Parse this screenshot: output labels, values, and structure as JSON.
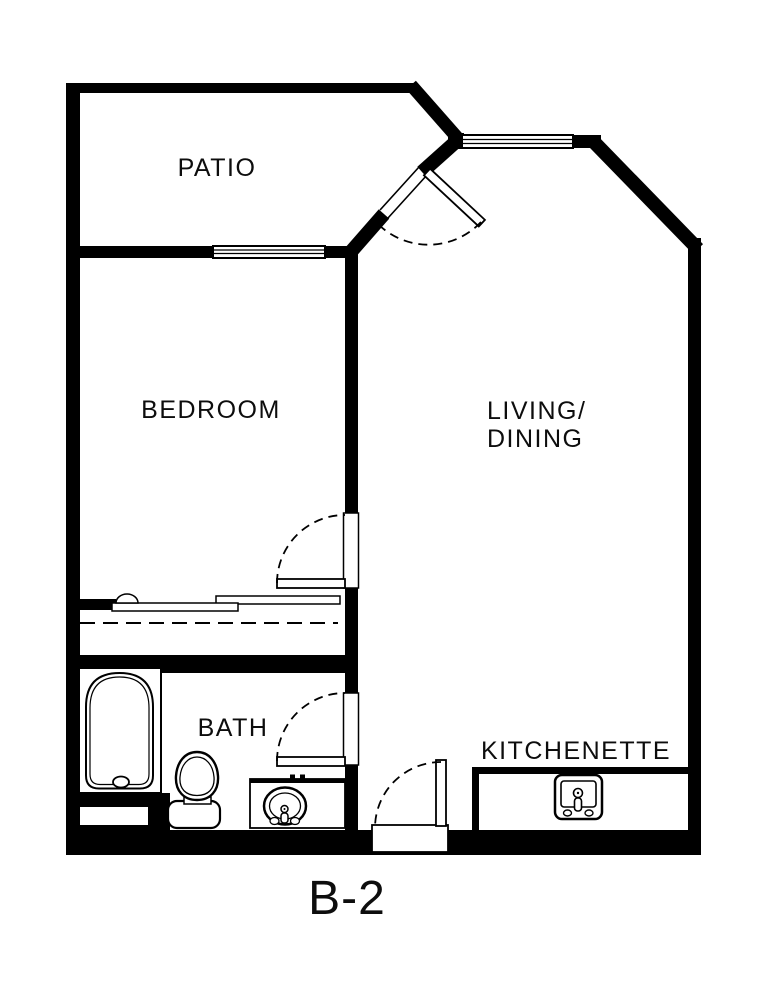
{
  "plan": {
    "title": "B-2"
  },
  "colors": {
    "wall": "#000000",
    "background": "#ffffff",
    "label_text": "#0d0d0d"
  },
  "rooms": {
    "patio": {
      "label": "PATIO"
    },
    "bedroom": {
      "label": "BEDROOM"
    },
    "living_dining": {
      "label_line1": "LIVING/",
      "label_line2": "DINING"
    },
    "bath": {
      "label": "BATH"
    },
    "kitchenette": {
      "label": "KITCHENETTE"
    }
  },
  "fixtures": [
    "bathtub",
    "toilet",
    "bathroom-sink-vanity",
    "kitchenette-counter",
    "kitchenette-sink",
    "closet-sliding-doors",
    "closet-rod",
    "window-patio-bedroom",
    "window-living-north",
    "patio-door-swing",
    "bedroom-door-swing",
    "bath-door-swing",
    "entry-door-swing"
  ]
}
